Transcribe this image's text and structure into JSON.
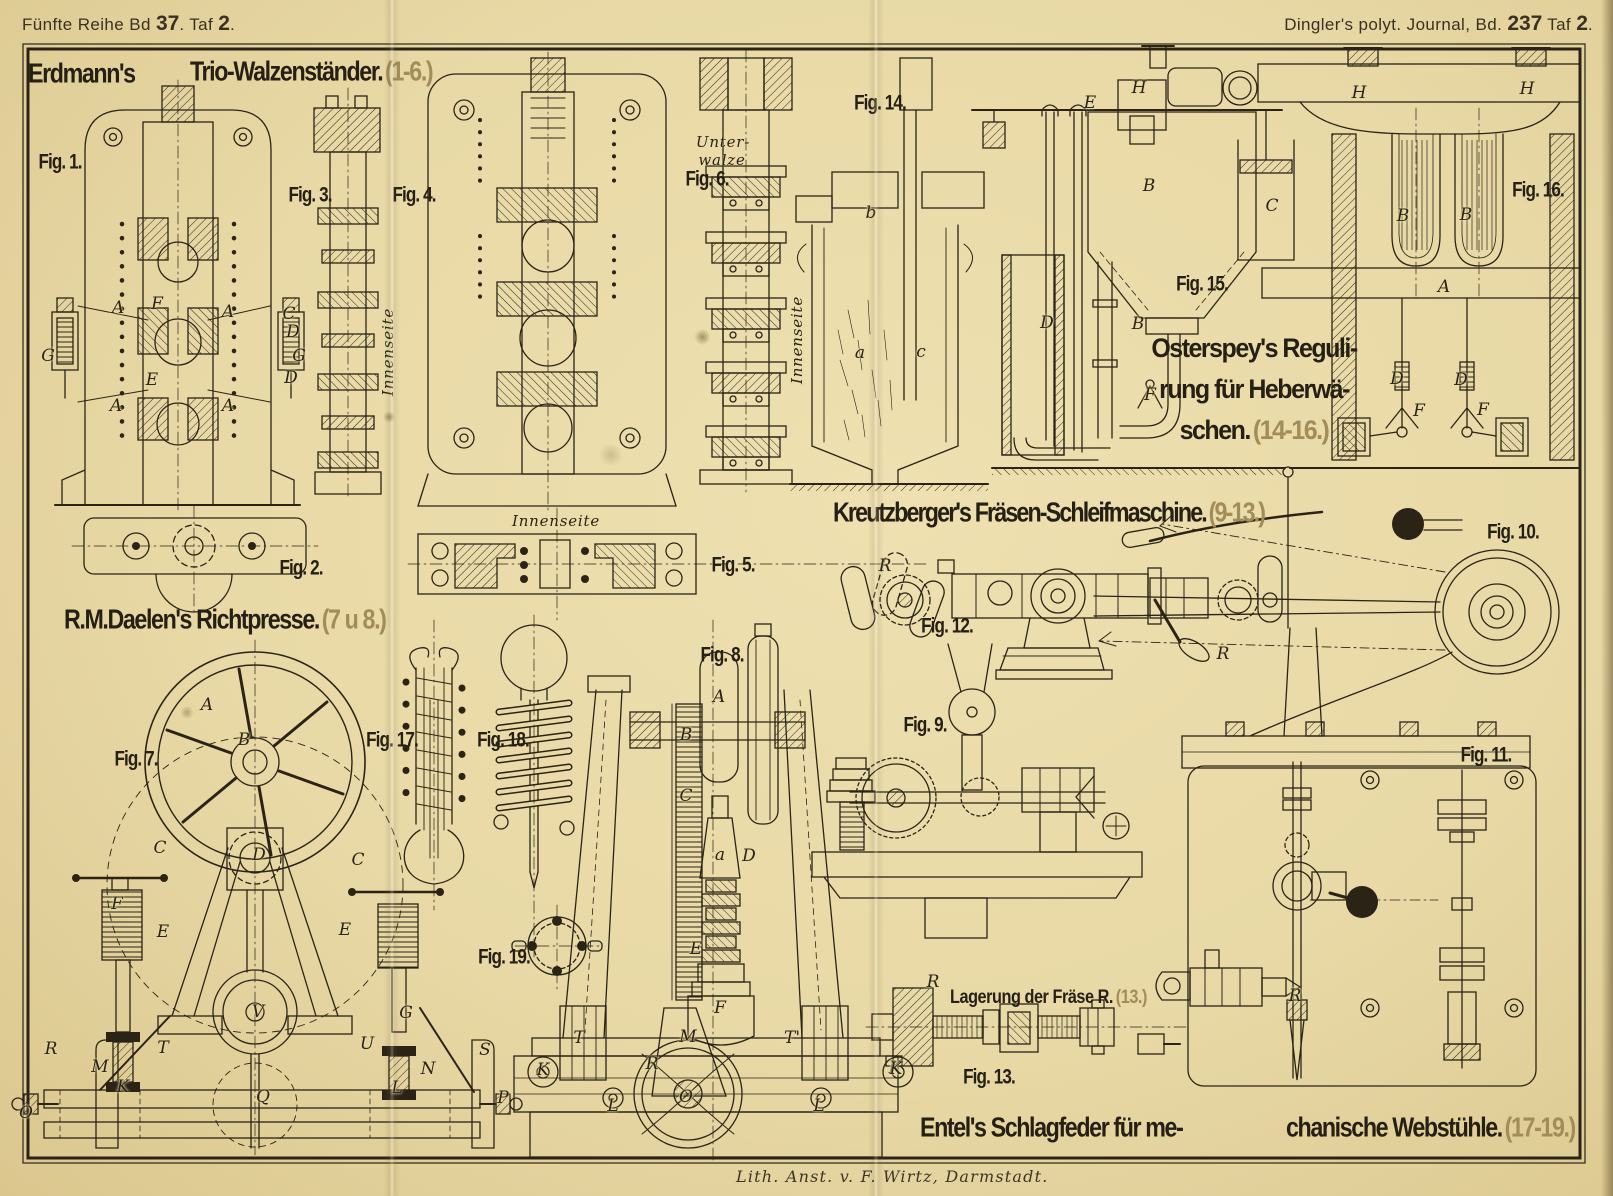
{
  "colors": {
    "paper": "#e8d9a6",
    "ink": "#2b2416",
    "faint": "#a28d58"
  },
  "header": {
    "left": {
      "pre": "Fünfte Reihe Bd ",
      "bd": "37",
      "mid": ". Taf ",
      "taf": "2",
      "post": "."
    },
    "right": {
      "pre": "Dingler's polyt. Journal, Bd. ",
      "bd": "237",
      "mid": " Taf ",
      "taf": "2",
      "post": "."
    }
  },
  "sections": {
    "erdmann": {
      "name": "Erdmann's",
      "title": "Trio-Walzenständer.",
      "figures": "(1-6.)"
    },
    "osterspey": {
      "line1": "Osterspey's Reguli-",
      "line2": "rung für Heberwä-",
      "line3": "schen.",
      "figures": "(14-16.)"
    },
    "kreutzberger": {
      "title": "Kreutzberger's Fräsen-Schleifmaschine.",
      "figures": "(9-13.)"
    },
    "daelen": {
      "title": "R.M.Daelen's Richtpresse.",
      "figures": "(7 u 8.)"
    },
    "lagerung": {
      "title": "Lagerung der Fräse R.",
      "figures": "(13.)"
    },
    "entel": {
      "part1": "Entel's Schlagfeder für me-",
      "part2": "chanische Webstühle.",
      "figures": "(17-19.)"
    }
  },
  "figure_labels": [
    {
      "text": "Fig. 1.",
      "x": 60,
      "y": 163
    },
    {
      "text": "Fig. 2.",
      "x": 301,
      "y": 569
    },
    {
      "text": "Fig. 3.",
      "x": 310,
      "y": 196
    },
    {
      "text": "Fig. 4.",
      "x": 414,
      "y": 196
    },
    {
      "text": "Fig. 5.",
      "x": 733,
      "y": 566
    },
    {
      "text": "Fig. 6.",
      "x": 707,
      "y": 180
    },
    {
      "text": "Fig. 7.",
      "x": 136,
      "y": 760
    },
    {
      "text": "Fig. 8.",
      "x": 722,
      "y": 656
    },
    {
      "text": "Fig. 9.",
      "x": 925,
      "y": 726
    },
    {
      "text": "Fig. 10.",
      "x": 1513,
      "y": 533
    },
    {
      "text": "Fig. 11.",
      "x": 1486,
      "y": 756
    },
    {
      "text": "Fig. 12.",
      "x": 947,
      "y": 627
    },
    {
      "text": "Fig. 13.",
      "x": 989,
      "y": 1078
    },
    {
      "text": "Fig. 14.",
      "x": 880,
      "y": 104
    },
    {
      "text": "Fig. 15.",
      "x": 1202,
      "y": 285
    },
    {
      "text": "Fig. 16.",
      "x": 1538,
      "y": 191
    },
    {
      "text": "Fig. 17.",
      "x": 392,
      "y": 741
    },
    {
      "text": "Fig. 18.",
      "x": 503,
      "y": 741
    },
    {
      "text": "Fig. 19.",
      "x": 504,
      "y": 958
    }
  ],
  "part_letters": [
    {
      "text": "A",
      "x": 118,
      "y": 308
    },
    {
      "text": "F",
      "x": 157,
      "y": 304
    },
    {
      "text": "A",
      "x": 228,
      "y": 312
    },
    {
      "text": "C",
      "x": 289,
      "y": 314
    },
    {
      "text": "D",
      "x": 293,
      "y": 332
    },
    {
      "text": "G",
      "x": 48,
      "y": 356
    },
    {
      "text": "G",
      "x": 299,
      "y": 356
    },
    {
      "text": "E",
      "x": 152,
      "y": 380
    },
    {
      "text": "A",
      "x": 116,
      "y": 406
    },
    {
      "text": "A",
      "x": 228,
      "y": 406
    },
    {
      "text": "D",
      "x": 291,
      "y": 378
    },
    {
      "text": "b",
      "x": 871,
      "y": 213
    },
    {
      "text": "a",
      "x": 860,
      "y": 353
    },
    {
      "text": "c",
      "x": 921,
      "y": 352
    },
    {
      "text": "E",
      "x": 1090,
      "y": 103
    },
    {
      "text": "H",
      "x": 1139,
      "y": 88
    },
    {
      "text": "B",
      "x": 1149,
      "y": 186
    },
    {
      "text": "C",
      "x": 1272,
      "y": 206
    },
    {
      "text": "B",
      "x": 1138,
      "y": 324
    },
    {
      "text": "D",
      "x": 1047,
      "y": 323
    },
    {
      "text": "F",
      "x": 1150,
      "y": 395
    },
    {
      "text": "H",
      "x": 1359,
      "y": 93
    },
    {
      "text": "H",
      "x": 1527,
      "y": 89
    },
    {
      "text": "B",
      "x": 1403,
      "y": 216
    },
    {
      "text": "B",
      "x": 1466,
      "y": 215
    },
    {
      "text": "A",
      "x": 1444,
      "y": 287
    },
    {
      "text": "D",
      "x": 1397,
      "y": 379
    },
    {
      "text": "D",
      "x": 1461,
      "y": 380
    },
    {
      "text": "F",
      "x": 1419,
      "y": 411
    },
    {
      "text": "F",
      "x": 1483,
      "y": 410
    },
    {
      "text": "R",
      "x": 885,
      "y": 566
    },
    {
      "text": "R",
      "x": 1223,
      "y": 654
    },
    {
      "text": "R",
      "x": 1295,
      "y": 996
    },
    {
      "text": "R",
      "x": 933,
      "y": 982
    },
    {
      "text": "K",
      "x": 895,
      "y": 1068
    },
    {
      "text": "A",
      "x": 207,
      "y": 705
    },
    {
      "text": "B",
      "x": 244,
      "y": 740
    },
    {
      "text": "C",
      "x": 160,
      "y": 848
    },
    {
      "text": "C",
      "x": 358,
      "y": 860
    },
    {
      "text": "D",
      "x": 259,
      "y": 855
    },
    {
      "text": "F",
      "x": 117,
      "y": 904
    },
    {
      "text": "E",
      "x": 163,
      "y": 932
    },
    {
      "text": "E",
      "x": 345,
      "y": 930
    },
    {
      "text": "R",
      "x": 51,
      "y": 1049
    },
    {
      "text": "M",
      "x": 100,
      "y": 1067
    },
    {
      "text": "T",
      "x": 163,
      "y": 1048
    },
    {
      "text": "K",
      "x": 123,
      "y": 1087
    },
    {
      "text": "V",
      "x": 258,
      "y": 1012
    },
    {
      "text": "Q",
      "x": 263,
      "y": 1097
    },
    {
      "text": "U",
      "x": 367,
      "y": 1044
    },
    {
      "text": "G",
      "x": 406,
      "y": 1013
    },
    {
      "text": "N",
      "x": 428,
      "y": 1069
    },
    {
      "text": "L",
      "x": 397,
      "y": 1088
    },
    {
      "text": "S",
      "x": 485,
      "y": 1050
    },
    {
      "text": "P",
      "x": 503,
      "y": 1098
    },
    {
      "text": "O",
      "x": 26,
      "y": 1113
    },
    {
      "text": "A",
      "x": 719,
      "y": 697
    },
    {
      "text": "B",
      "x": 686,
      "y": 735
    },
    {
      "text": "C",
      "x": 686,
      "y": 796
    },
    {
      "text": "D",
      "x": 749,
      "y": 856
    },
    {
      "text": "a",
      "x": 720,
      "y": 855
    },
    {
      "text": "E",
      "x": 696,
      "y": 949
    },
    {
      "text": "T",
      "x": 579,
      "y": 1038
    },
    {
      "text": "M",
      "x": 688,
      "y": 1037
    },
    {
      "text": "F",
      "x": 720,
      "y": 1008
    },
    {
      "text": "R",
      "x": 652,
      "y": 1064
    },
    {
      "text": "O",
      "x": 686,
      "y": 1097
    },
    {
      "text": "K",
      "x": 543,
      "y": 1070
    },
    {
      "text": "L",
      "x": 613,
      "y": 1106
    },
    {
      "text": "T'",
      "x": 792,
      "y": 1038
    },
    {
      "text": "L",
      "x": 819,
      "y": 1106
    },
    {
      "text": "K",
      "x": 896,
      "y": 1069
    }
  ],
  "notes": [
    {
      "text": "Unter-",
      "x": 723,
      "y": 142
    },
    {
      "text": "walze",
      "x": 722,
      "y": 160
    },
    {
      "text": "Innenseite",
      "x": 388,
      "y": 352,
      "rot": -90
    },
    {
      "text": "Innenseite",
      "x": 797,
      "y": 340,
      "rot": -90
    },
    {
      "text": "Innenseite",
      "x": 556,
      "y": 521
    }
  ],
  "footer": {
    "credit": "Lith. Anst. v. F. Wirtz, Darmstadt."
  }
}
